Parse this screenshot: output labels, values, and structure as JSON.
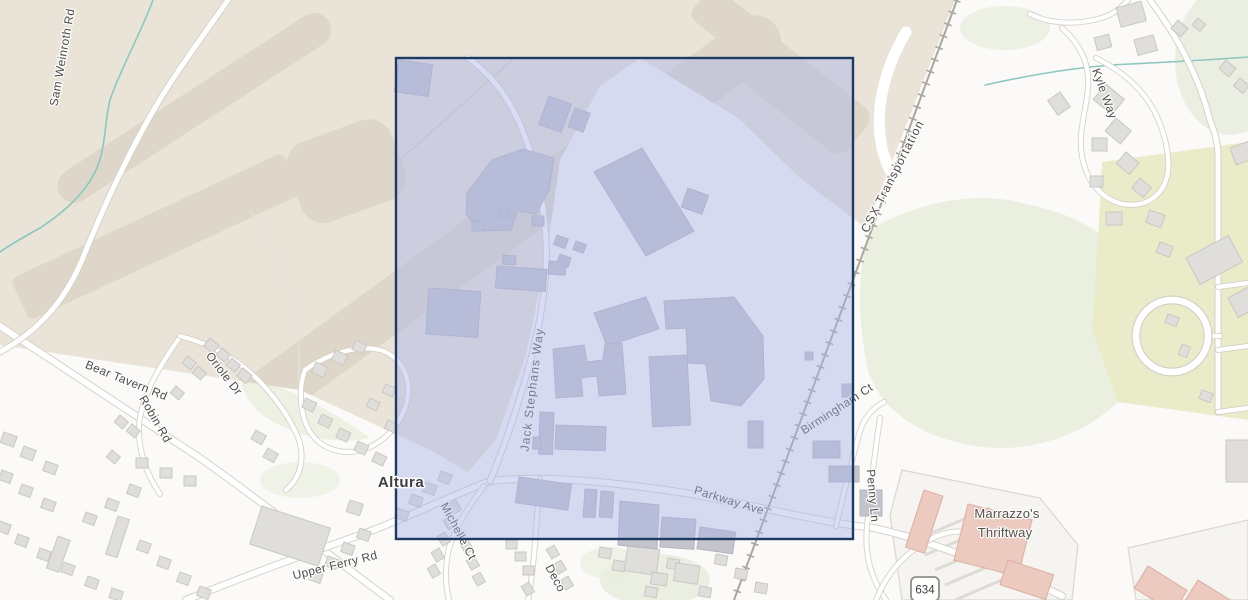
{
  "selection": {
    "fill": "rgba(168,180,232,0.45)",
    "border": "#1d3b62"
  },
  "labels": {
    "place": "Altura",
    "railroad": "CSX Transportation",
    "route_shield": "634",
    "poi": {
      "line1": "Marrazzo's",
      "line2": "Thriftway"
    },
    "roads": {
      "sam_weinroth": "Sam Weinroth Rd",
      "bear_tavern": "Bear Tavern Rd",
      "oriole": "Oriole Dr",
      "robin": "Robin Rd",
      "upper_ferry": "Upper Ferry Rd",
      "michelle": "Michelle Ct",
      "deco": "Deco",
      "jack_stephans": "Jack Stephans Way",
      "parkway": "Parkway Ave",
      "birmingham": "Birmingham Ct",
      "penny": "Penny Ln",
      "kyle": "Kyle Way"
    }
  },
  "palette": {
    "airport_land": "#eae4d8",
    "runway": "#ded7c9",
    "landcover_green": "#e7ecdc",
    "development_green": "#e9ebc9",
    "water": "#8cc7bf",
    "road": "#ffffff",
    "building": "#dfdedb",
    "industrial_building": "#c4c4cd",
    "commercial_building": "#eccabf",
    "railroad": "#aaa79f",
    "label_text": "#4c4c4c",
    "place_label_text": "#3e3e45"
  }
}
